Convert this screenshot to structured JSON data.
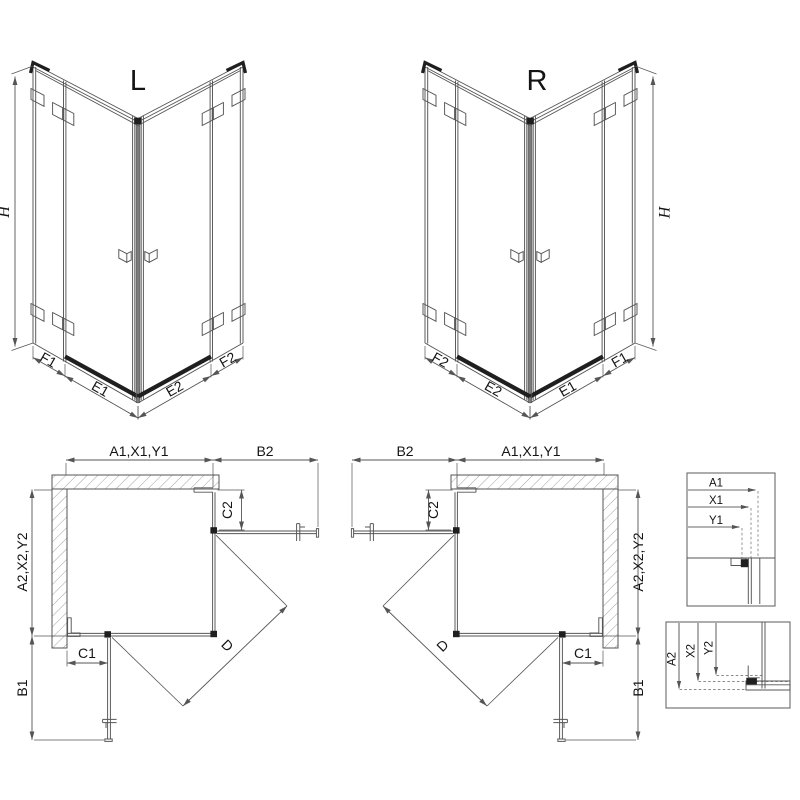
{
  "iso_left": {
    "label": "L",
    "dim_h": "H",
    "dim_f1": "F1",
    "dim_e1": "E1",
    "dim_e2": "E2",
    "dim_f2": "F2"
  },
  "iso_right": {
    "label": "R",
    "dim_h": "H",
    "dim_f1": "F1",
    "dim_e1": "E1",
    "dim_e2": "E2",
    "dim_f2": "F2"
  },
  "plan_left": {
    "dim_width_top": "A1,X1,Y1",
    "dim_b2": "B2",
    "dim_side": "A2,X2,Y2",
    "dim_c2": "C2",
    "dim_c1": "C1",
    "dim_b1": "B1",
    "dim_d": "D"
  },
  "plan_right": {
    "dim_width_top": "A1,X1,Y1",
    "dim_b2": "B2",
    "dim_side": "A2,X2,Y2",
    "dim_c2": "C2",
    "dim_c1": "C1",
    "dim_b1": "B1",
    "dim_d": "D"
  },
  "detail_widths": {
    "labels": [
      "A1",
      "X1",
      "Y1"
    ]
  },
  "detail_heights": {
    "labels": [
      "A2",
      "X2",
      "Y2"
    ]
  },
  "colors": {
    "line": "#555555",
    "dark": "#1f1f1f",
    "label": "#141414",
    "hatch": "#8a8a8a",
    "detail_line": "#9a9a9a",
    "background": "#ffffff"
  }
}
